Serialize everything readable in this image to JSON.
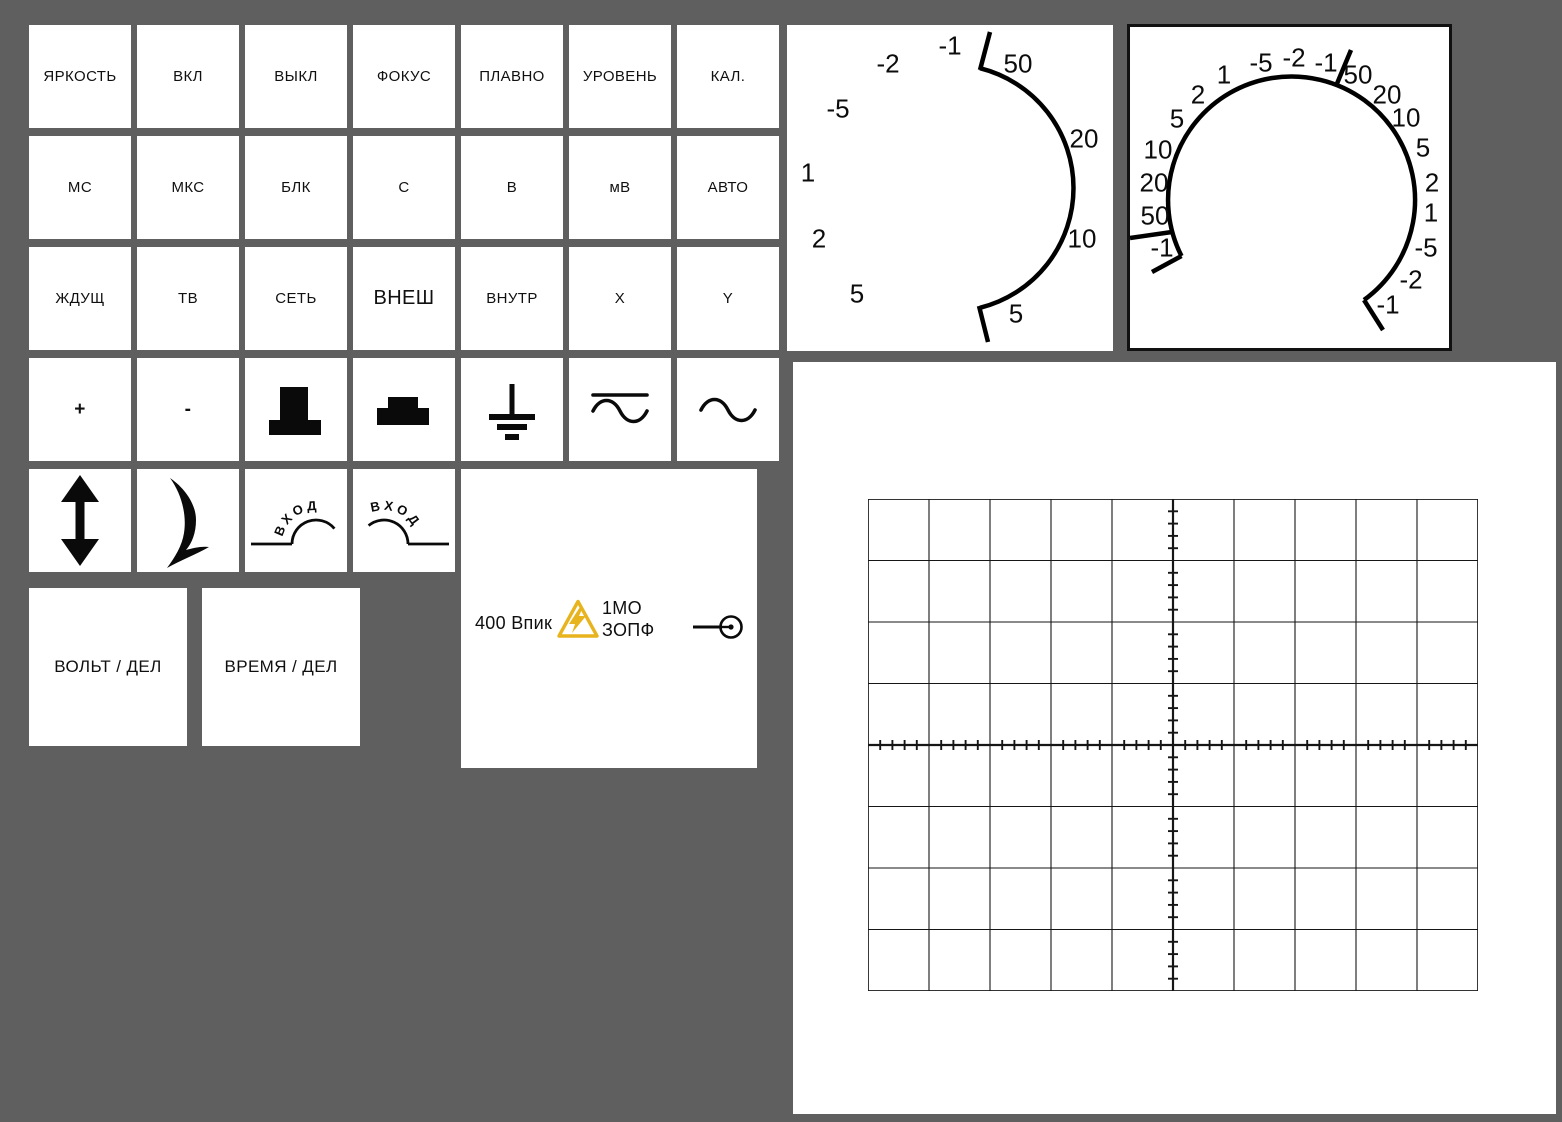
{
  "background_color": "#5f5f5f",
  "warning_color": "#e8b41e",
  "button_grid": {
    "text_rows": [
      [
        {
          "label": "ЯРКОСТЬ",
          "name": "brightness"
        },
        {
          "label": "ВКЛ",
          "name": "on"
        },
        {
          "label": "ВЫКЛ",
          "name": "off"
        },
        {
          "label": "ФОКУС",
          "name": "focus"
        },
        {
          "label": "ПЛАВНО",
          "name": "smooth"
        },
        {
          "label": "УРОВЕНЬ",
          "name": "level"
        },
        {
          "label": "КАЛ.",
          "name": "cal"
        }
      ],
      [
        {
          "label": "МС",
          "name": "ms"
        },
        {
          "label": "МКС",
          "name": "us"
        },
        {
          "label": "БЛК",
          "name": "blanking"
        },
        {
          "label": "С",
          "name": "s"
        },
        {
          "label": "В",
          "name": "v"
        },
        {
          "label": "мВ",
          "name": "mv"
        },
        {
          "label": "АВТО",
          "name": "auto"
        }
      ],
      [
        {
          "label": "ЖДУЩ",
          "name": "triggered"
        },
        {
          "label": "ТВ",
          "name": "tv"
        },
        {
          "label": "СЕТЬ",
          "name": "mains"
        },
        {
          "label": "ВНЕШ",
          "name": "external",
          "big": true
        },
        {
          "label": "ВНУТР",
          "name": "internal"
        },
        {
          "label": "X",
          "name": "x"
        },
        {
          "label": "Y",
          "name": "y"
        }
      ]
    ],
    "plus_label": "+",
    "minus_label": "-",
    "input_label": "ВХОД"
  },
  "volt_div_label": "ВОЛЬТ / ДЕЛ",
  "time_div_label": "ВРЕМЯ / ДЕЛ",
  "info_panel": {
    "max_voltage": "400 Впик",
    "impedance_line1": "1МО",
    "impedance_line2": "ЗОПФ"
  },
  "dial_left": {
    "labels": [
      {
        "t": "-1",
        "x": 163,
        "y": 21
      },
      {
        "t": "-2",
        "x": 101,
        "y": 39
      },
      {
        "t": "-5",
        "x": 51,
        "y": 84
      },
      {
        "t": "1",
        "x": 21,
        "y": 148
      },
      {
        "t": "2",
        "x": 32,
        "y": 214
      },
      {
        "t": "5",
        "x": 70,
        "y": 269
      },
      {
        "t": "50",
        "x": 231,
        "y": 39
      },
      {
        "t": "20",
        "x": 297,
        "y": 114
      },
      {
        "t": "10",
        "x": 295,
        "y": 214
      },
      {
        "t": "5",
        "x": 229,
        "y": 289
      }
    ]
  },
  "dial_right": {
    "labels": [
      {
        "t": "-1",
        "x": 35,
        "y": 224
      },
      {
        "t": "50",
        "x": 28,
        "y": 192
      },
      {
        "t": "20",
        "x": 27,
        "y": 159
      },
      {
        "t": "10",
        "x": 31,
        "y": 126
      },
      {
        "t": "5",
        "x": 50,
        "y": 95
      },
      {
        "t": "2",
        "x": 71,
        "y": 71
      },
      {
        "t": "1",
        "x": 97,
        "y": 51
      },
      {
        "t": "-5",
        "x": 134,
        "y": 39
      },
      {
        "t": "-2",
        "x": 167,
        "y": 34
      },
      {
        "t": "-1",
        "x": 199,
        "y": 39
      },
      {
        "t": "50",
        "x": 231,
        "y": 51
      },
      {
        "t": "20",
        "x": 260,
        "y": 71
      },
      {
        "t": "10",
        "x": 279,
        "y": 94
      },
      {
        "t": "5",
        "x": 296,
        "y": 124
      },
      {
        "t": "2",
        "x": 305,
        "y": 159
      },
      {
        "t": "1",
        "x": 304,
        "y": 189
      },
      {
        "t": "-5",
        "x": 299,
        "y": 224
      },
      {
        "t": "-2",
        "x": 284,
        "y": 256
      },
      {
        "t": "-1",
        "x": 261,
        "y": 281
      }
    ]
  },
  "graticule": {
    "cols": 10,
    "rows": 8,
    "cell_w": 61,
    "cell_h": 61.5,
    "minor_per_div": 5,
    "tick_len": 10
  }
}
